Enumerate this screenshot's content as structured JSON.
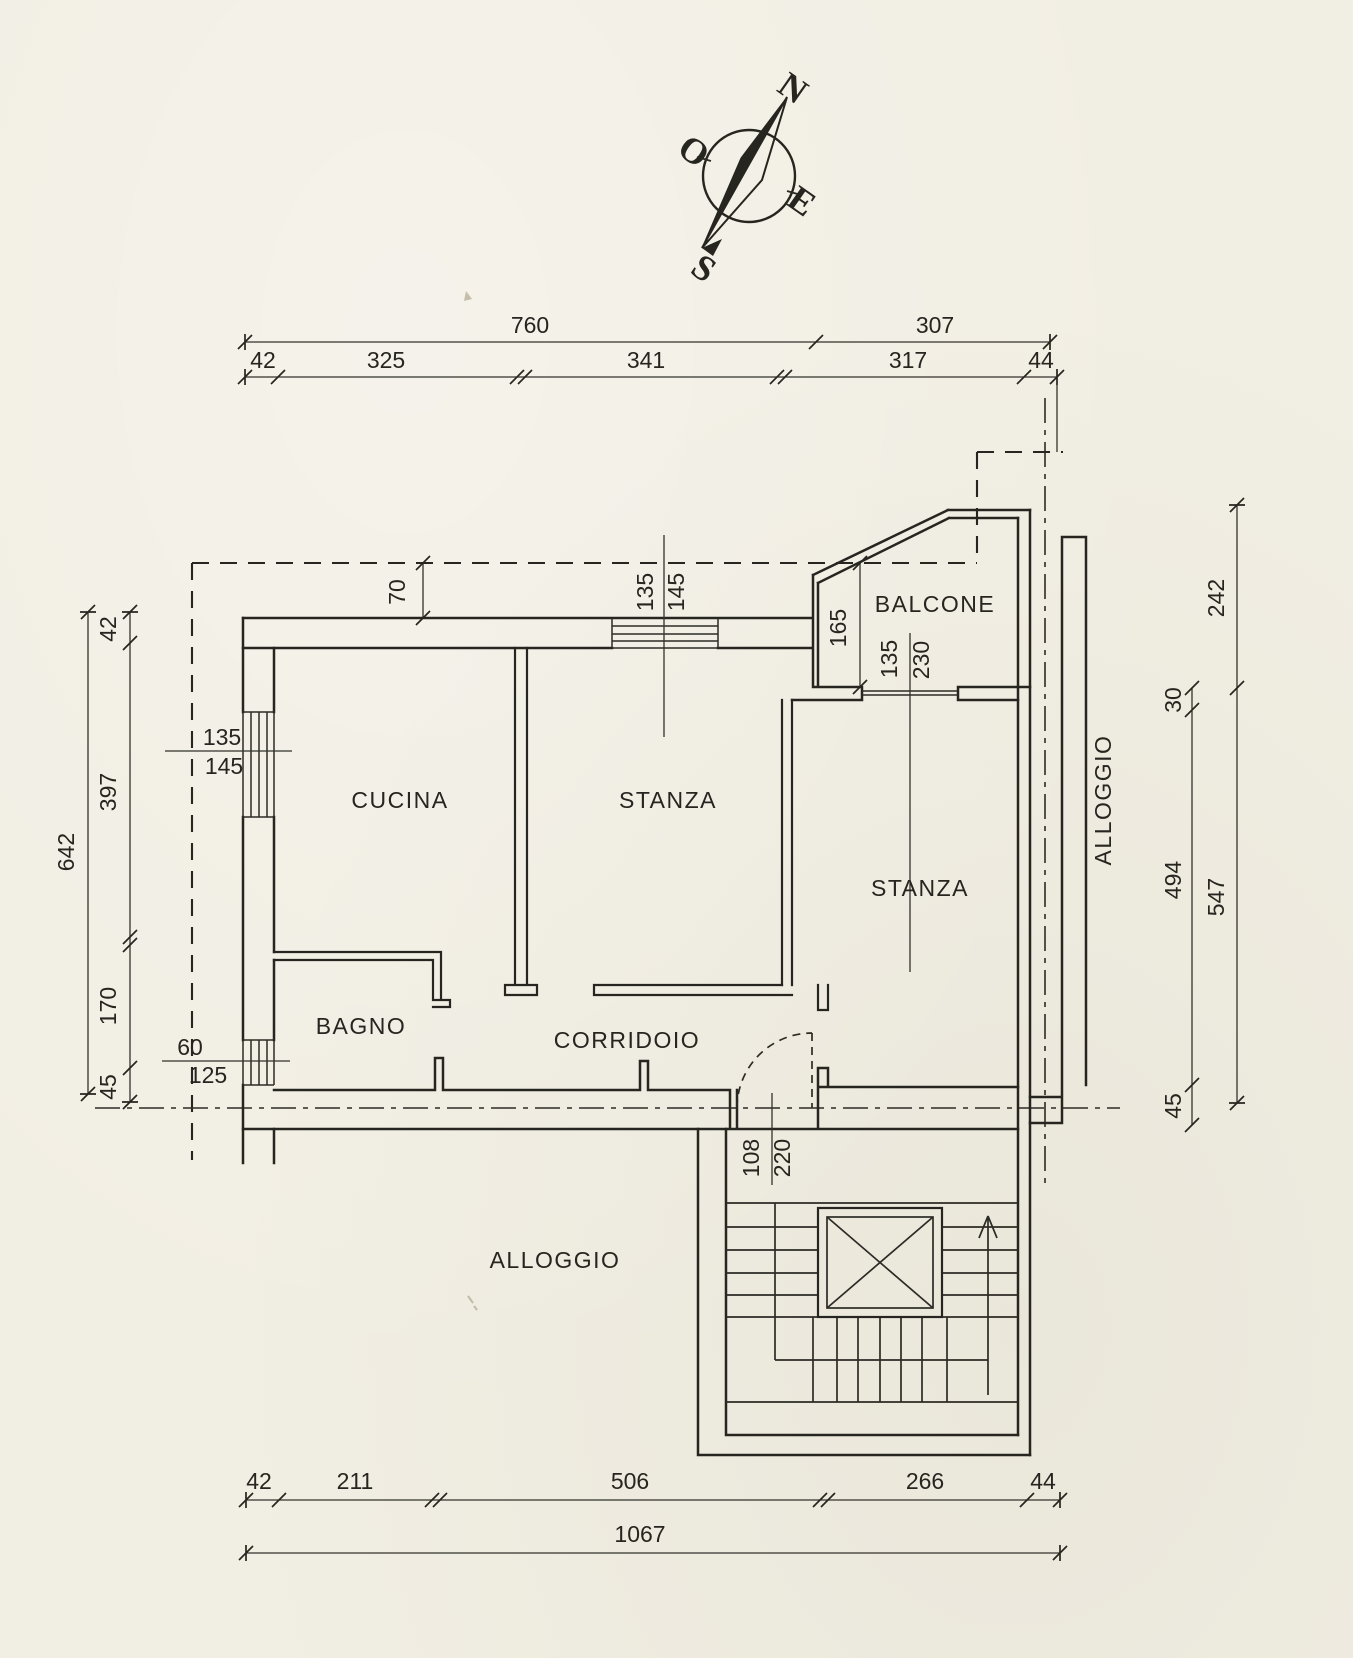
{
  "canvas": {
    "paper_color": "#f1eee3",
    "ink_color": "#26251f"
  },
  "compass": {
    "north": "N",
    "west": "O",
    "east": "E",
    "south": "S"
  },
  "rooms": {
    "cucina": "CUCINA",
    "stanza_mid": "STANZA",
    "stanza_right": "STANZA",
    "bagno": "BAGNO",
    "corridoio": "CORRIDOIO",
    "balcone": "BALCONE",
    "alloggio_right": "ALLOGGIO",
    "alloggio_bottom": "ALLOGGIO"
  },
  "dims": {
    "top": {
      "d760": "760",
      "d307": "307",
      "d42": "42",
      "d325": "325",
      "d341": "341",
      "d317": "317",
      "d44": "44"
    },
    "bottom": {
      "d42": "42",
      "d211": "211",
      "d506": "506",
      "d266": "266",
      "d44": "44",
      "total": "1067"
    },
    "left": {
      "total": "642",
      "d42": "42",
      "d397": "397",
      "d170": "170",
      "d45": "45"
    },
    "right": {
      "d242": "242",
      "d547": "547",
      "d30": "30",
      "d494": "494",
      "d45": "45"
    },
    "misc": {
      "setback": "70",
      "balcony_depth": "165"
    }
  },
  "openings": {
    "window_cucina": {
      "w": "135",
      "h": "145"
    },
    "window_stanza": {
      "w": "135",
      "h": "145"
    },
    "window_bagno": {
      "w": "60",
      "h": "125"
    },
    "door_balcone": {
      "w": "135",
      "h": "230"
    },
    "door_ingresso": {
      "w": "108",
      "h": "220"
    }
  }
}
